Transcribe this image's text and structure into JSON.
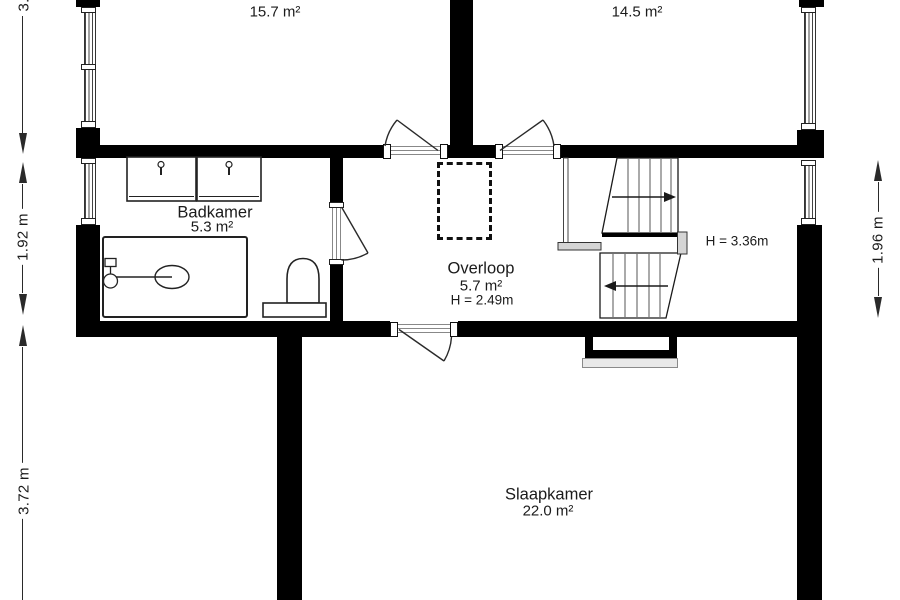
{
  "floorplan": {
    "rooms": {
      "top_left": {
        "area": "15.7 m²"
      },
      "top_right": {
        "area": "14.5 m²"
      },
      "badkamer": {
        "name": "Badkamer",
        "area": "5.3 m²"
      },
      "overloop": {
        "name": "Overloop",
        "area": "5.7 m²",
        "ceiling_height": "H = 2.49m"
      },
      "slaapkamer": {
        "name": "Slaapkamer",
        "area": "22.0 m²"
      }
    },
    "stairwell": {
      "ceiling_height": "H = 3.36m"
    },
    "dimensions": {
      "left_top": "3.7 m",
      "left_middle": "1.92 m",
      "left_bottom": "3.72 m",
      "right": "1.96 m"
    },
    "colors": {
      "wall": "#000000",
      "background": "#ffffff",
      "railing": "#d5d5d5",
      "text": "#1b1b1b"
    }
  }
}
